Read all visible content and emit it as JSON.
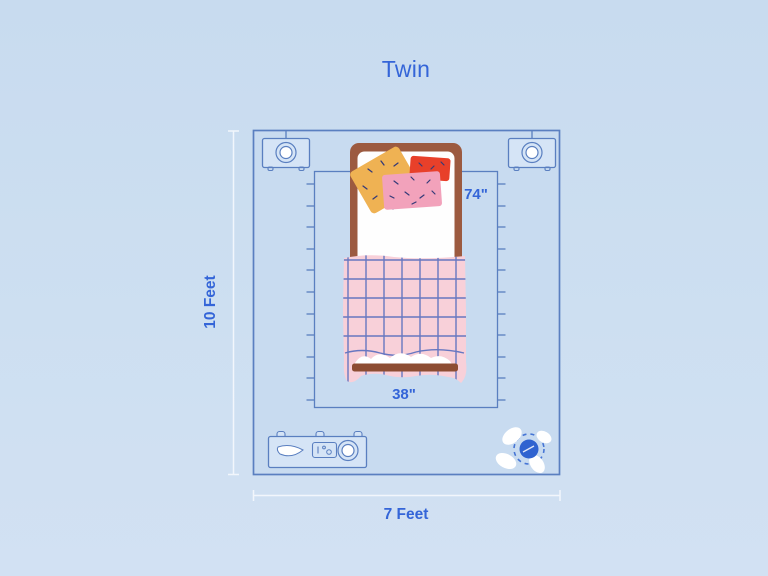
{
  "title": "Twin",
  "room": {
    "height_label": "10 Feet",
    "width_label": "7 Feet"
  },
  "bed": {
    "length_label": "74\"",
    "width_label": "38\""
  },
  "colors": {
    "background": "#cbdded",
    "room_fill": "#c8dbf0",
    "outline_blue": "#5a7fc0",
    "label_blue": "#3465d8",
    "dimension_line_white": "#f4f8fd",
    "bed_frame_brown": "#9c5a40",
    "footboard_brown": "#8d4d33",
    "sheet_white": "#ffffff",
    "blanket_pink": "#f8d0d9",
    "blanket_grid_blue": "#4e68bd",
    "pillow_orange": "#efb253",
    "pillow_red": "#e8402a",
    "pillow_pink": "#f2a2bb",
    "pillow_speckle": "#343a78",
    "plant_blue": "#2f63d0"
  }
}
